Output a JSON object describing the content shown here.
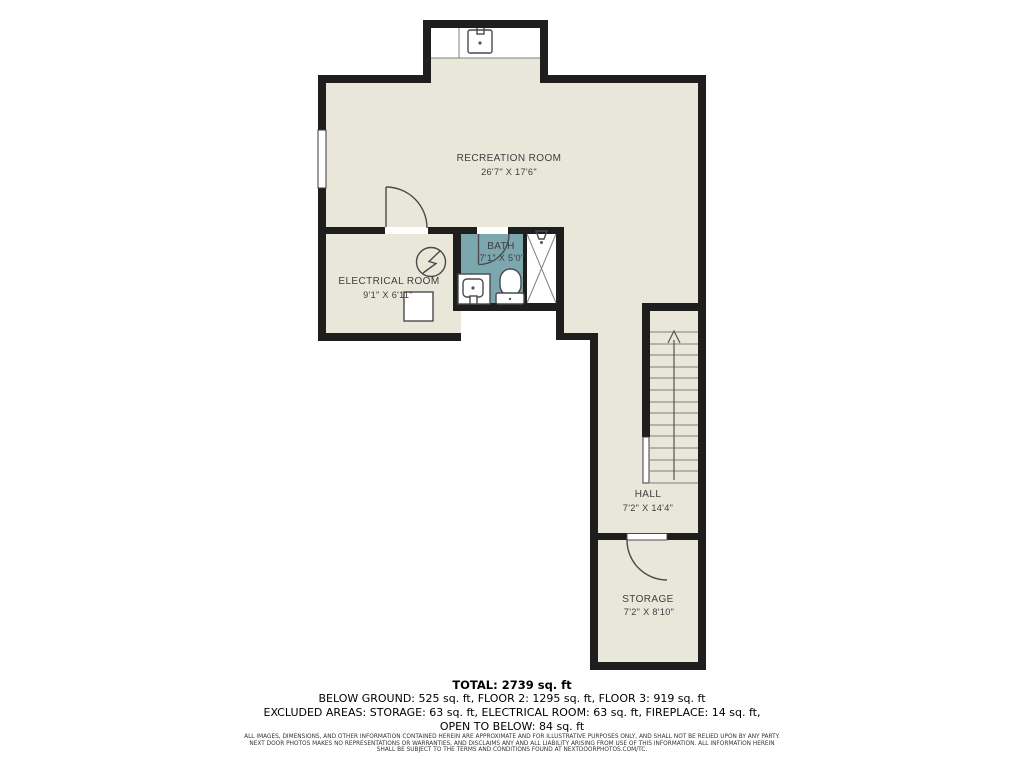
{
  "rooms": {
    "recreation": {
      "name": "RECREATION ROOM",
      "dims": "26'7\" X 17'6\""
    },
    "electrical": {
      "name": "ELECTRICAL ROOM",
      "dims": "9'1\" X 6'11\""
    },
    "bath": {
      "name": "BATH",
      "dims": "7'1\" X 5'0\""
    },
    "hall": {
      "name": "HALL",
      "dims": "7'2\" X 14'4\""
    },
    "storage": {
      "name": "STORAGE",
      "dims": "7'2\" X 8'10\""
    }
  },
  "summary": {
    "total": "TOTAL: 2739 sq. ft",
    "floors": "BELOW GROUND: 525 sq. ft, FLOOR 2: 1295 sq. ft, FLOOR 3: 919 sq. ft",
    "excluded": "EXCLUDED AREAS: STORAGE: 63 sq. ft, ELECTRICAL ROOM: 63 sq. ft, FIREPLACE: 14 sq. ft,",
    "excluded2": "OPEN TO BELOW: 84 sq. ft"
  },
  "disclaimer": {
    "line1": "ALL IMAGES, DIMENSIONS, AND OTHER INFORMATION CONTAINED HEREIN ARE APPROXIMATE AND FOR ILLUSTRATIVE PURPOSES ONLY, AND SHALL NOT BE RELIED UPON BY ANY PARTY.",
    "line2": "NEXT DOOR PHOTOS MAKES NO REPRESENTATIONS OR WARRANTIES, AND DISCLAIMS ANY AND ALL LIABILITY ARISING FROM USE OF THIS INFORMATION. ALL INFORMATION HEREIN",
    "line3": "SHALL BE SUBJECT TO THE TERMS AND CONDITIONS FOUND AT NEXTDOORPHOTOS.COM/TC."
  },
  "colors": {
    "wall": "#1e1e1c",
    "floor": "#e9e6da",
    "bath_floor": "#7da7ae",
    "label_text": "#3e3e3e"
  }
}
